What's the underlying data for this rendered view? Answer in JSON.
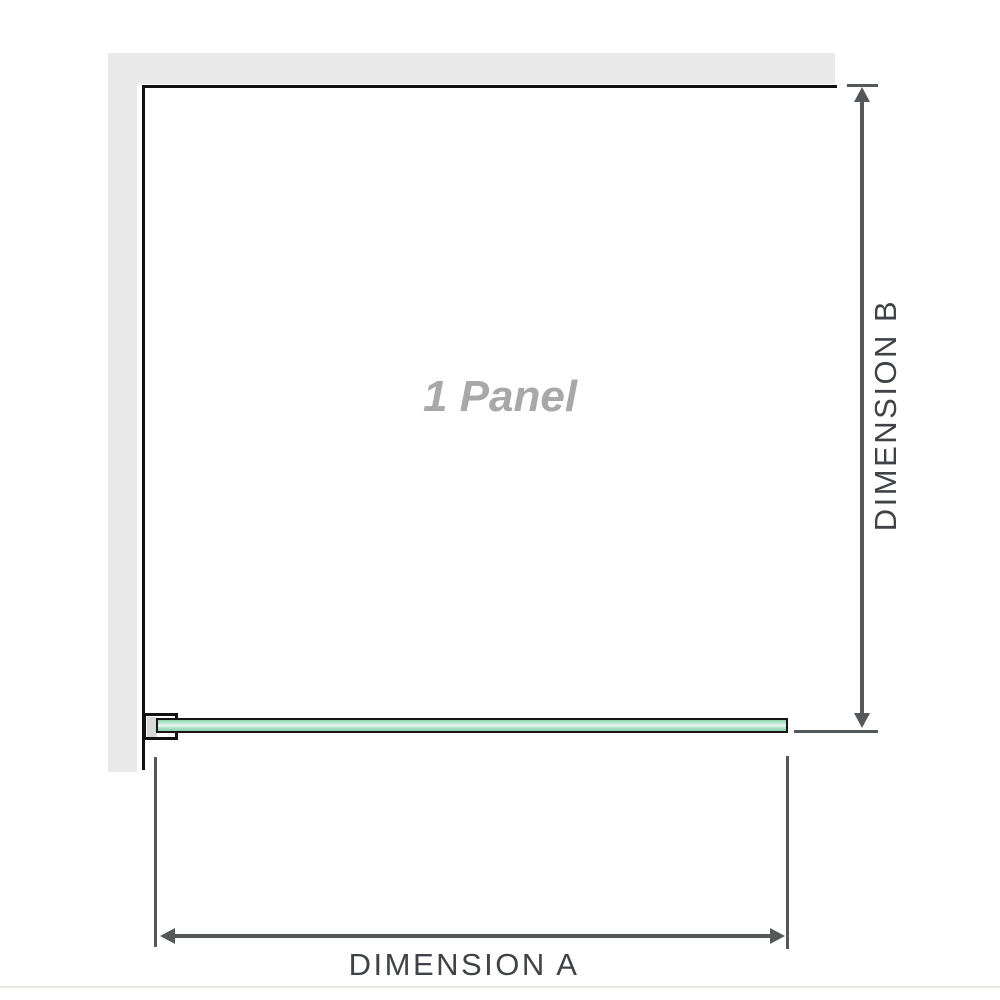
{
  "diagram": {
    "panel": {
      "label": "1 Panel"
    },
    "dimensions": {
      "a": {
        "label": "DIMENSION A"
      },
      "b": {
        "label": "DIMENSION B"
      }
    },
    "colors": {
      "wall": "#e9e9e9",
      "outline": "#111111",
      "dimension": "#54585b",
      "label": "#3f4347",
      "panel_label": "#a8a8a8",
      "glass_top": "#8ed3ae",
      "glass_mid": "#e9f7f0",
      "glass_bottom": "#8ccfa9",
      "glass_border": "#161616",
      "clamp_plate": "#d8d8d8",
      "baseline": "#eae6de"
    }
  }
}
